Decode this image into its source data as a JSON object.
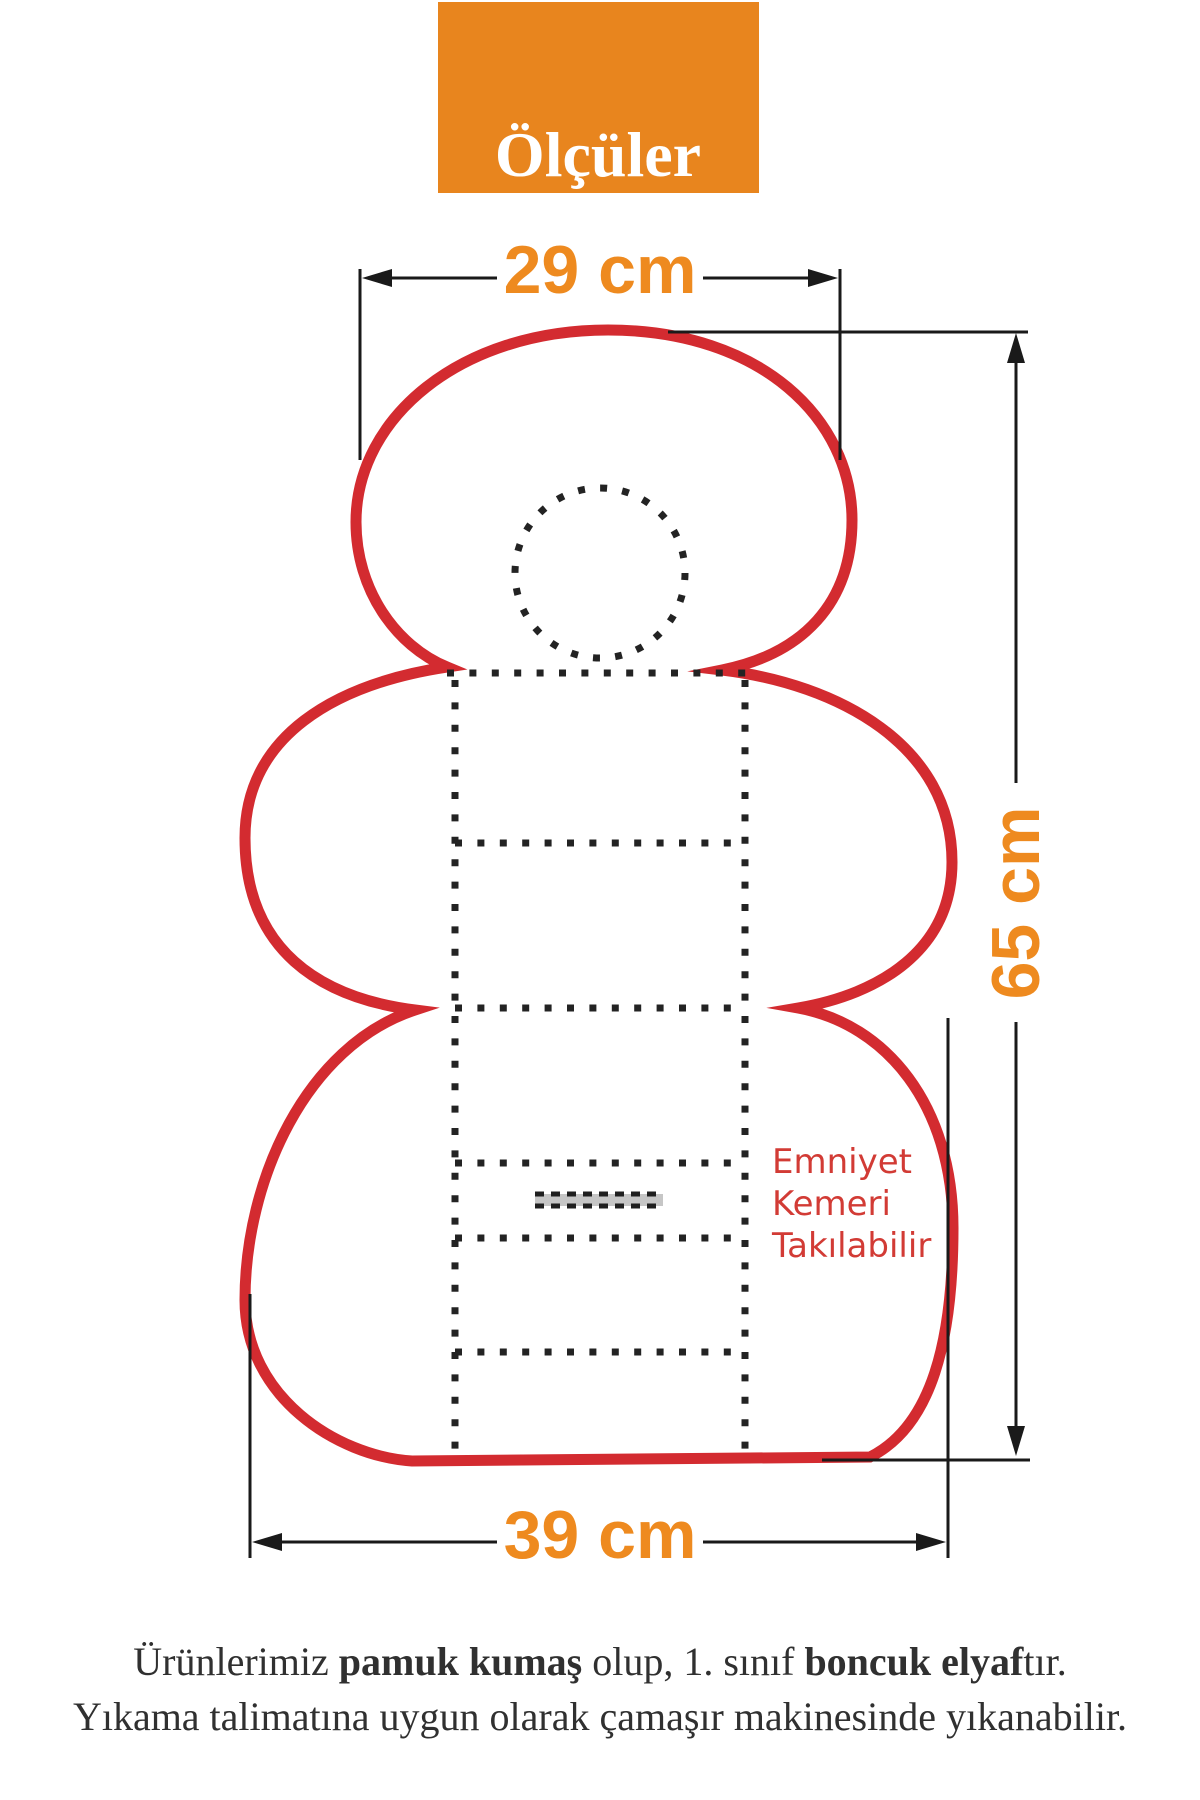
{
  "title_box": {
    "label": "Ölçüler"
  },
  "dimensions": {
    "top_width": "29 cm",
    "side_height": "65 cm",
    "bottom_width": "39 cm"
  },
  "belt_note": {
    "line1": "Emniyet",
    "line2": "Kemeri",
    "line3": "Takılabilir"
  },
  "footer": {
    "line1": {
      "seg1": "Ürünlerimiz ",
      "seg2": "pamuk kumaş",
      "seg3": " olup, 1. sınıf ",
      "seg4": "boncuk elyaf",
      "seg5": "tır."
    },
    "line2": "Yıkama talimatına uygun olarak çamaşır makinesinde yıkanabilir."
  },
  "colors": {
    "accent_orange": "#E8851E",
    "label_orange": "#EE8A1F",
    "outline_red": "#D32B30",
    "note_red": "#D23B35",
    "dimension_black": "#1A1A1A",
    "stitch_black": "#232323",
    "belt_slot_gray": "#C6C6C6",
    "footer_text": "#303030",
    "background": "#FFFFFF"
  }
}
